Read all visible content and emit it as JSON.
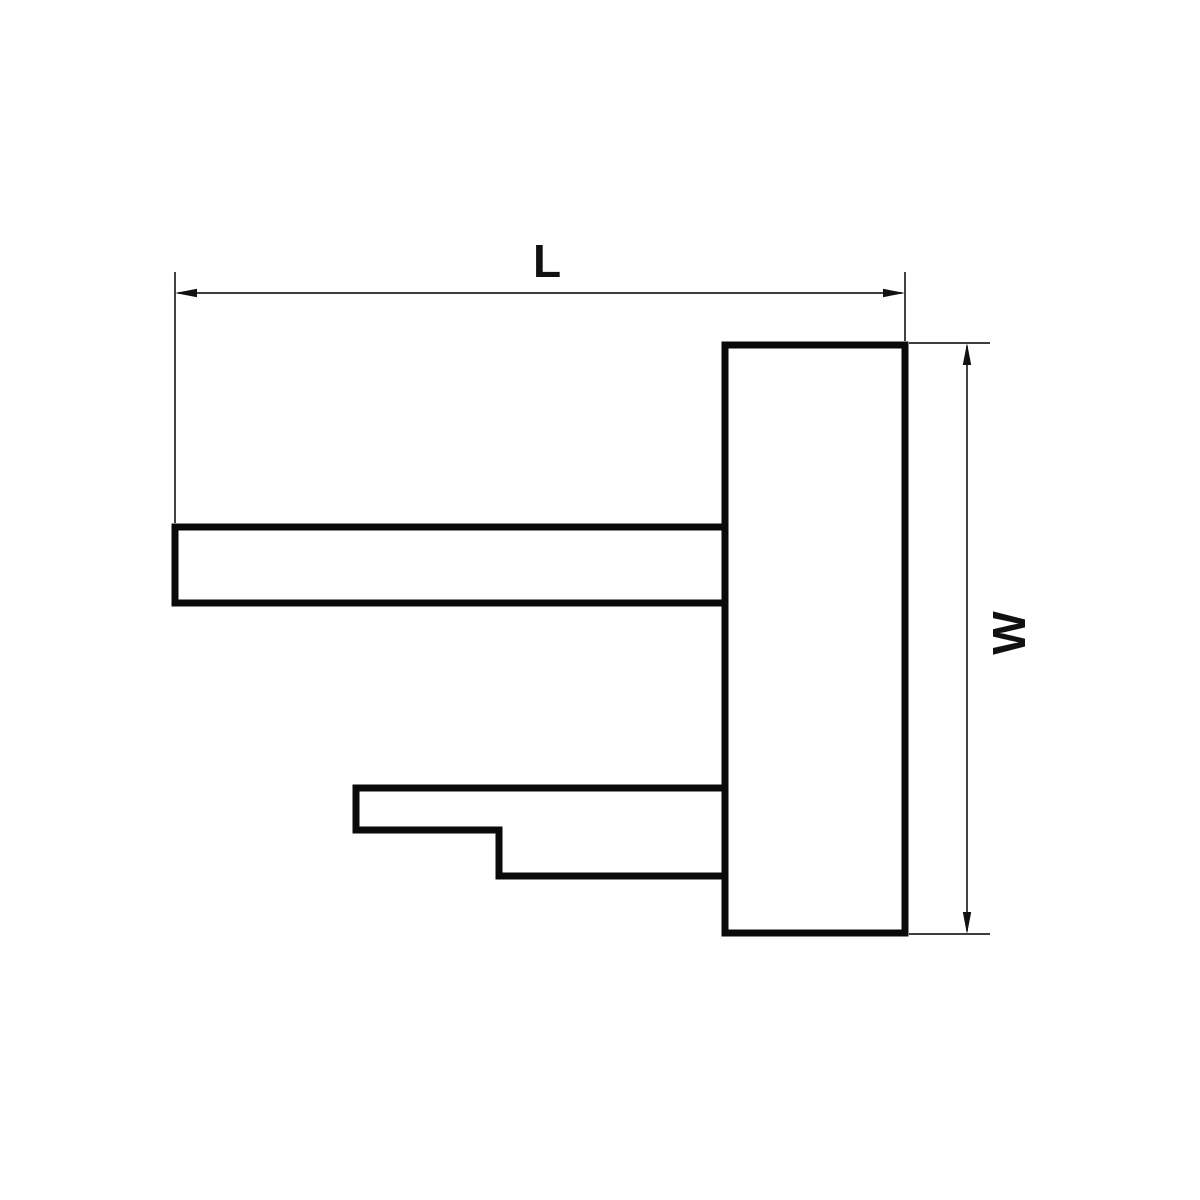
{
  "drawing": {
    "type": "technical-dimension-drawing",
    "labels": {
      "length": "L",
      "width": "W"
    },
    "colors": {
      "outline": "#0a0a0a",
      "dimension": "#222222",
      "background": "#ffffff"
    }
  }
}
